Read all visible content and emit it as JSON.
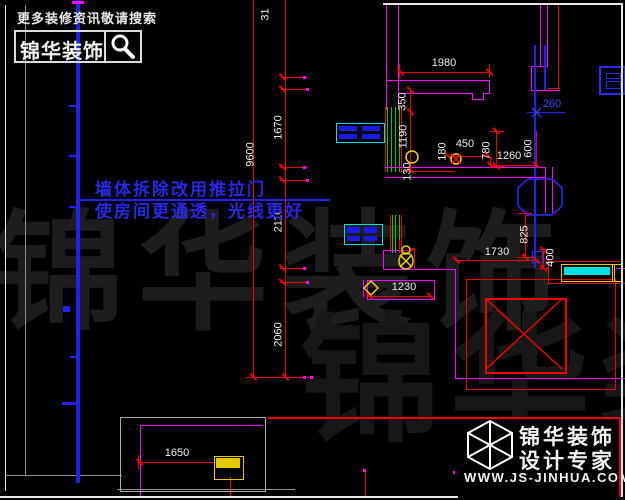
{
  "header": {
    "search_hint": "更多装修资讯敬请搜索",
    "brand": "锦华装饰"
  },
  "annotation": {
    "line1": "墙体拆除改用推拉门",
    "line2": "使房间更通透，光线更好"
  },
  "watermark": {
    "row1": "锦华装饰",
    "row2": "锦华装饰"
  },
  "footer_logo": {
    "brand": "锦华装饰",
    "tagline": "设计专家",
    "url": "WWW.JS-JINHUA.COM"
  },
  "dimensions": [
    {
      "t": "31",
      "x": 266,
      "y": 15,
      "o": "v"
    },
    {
      "t": "9600",
      "x": 251,
      "y": 155,
      "o": "v"
    },
    {
      "t": "1670",
      "x": 279,
      "y": 128,
      "o": "v"
    },
    {
      "t": "2110",
      "x": 279,
      "y": 221,
      "o": "v"
    },
    {
      "t": "2060",
      "x": 279,
      "y": 335,
      "o": "v"
    },
    {
      "t": "1980",
      "x": 444,
      "y": 64,
      "o": "h"
    },
    {
      "t": "350",
      "x": 403,
      "y": 102,
      "o": "v"
    },
    {
      "t": "1190",
      "x": 404,
      "y": 137,
      "o": "v"
    },
    {
      "t": "130",
      "x": 408,
      "y": 172,
      "o": "v"
    },
    {
      "t": "180",
      "x": 443,
      "y": 152,
      "o": "v"
    },
    {
      "t": "450",
      "x": 465,
      "y": 145,
      "o": "h"
    },
    {
      "t": "780",
      "x": 487,
      "y": 151,
      "o": "v"
    },
    {
      "t": "600",
      "x": 529,
      "y": 149,
      "o": "v"
    },
    {
      "t": "1260",
      "x": 509,
      "y": 157,
      "o": "h"
    },
    {
      "t": "260",
      "x": 552,
      "y": 105,
      "o": "h",
      "c": "blue"
    },
    {
      "t": "825",
      "x": 525,
      "y": 235,
      "o": "v"
    },
    {
      "t": "1730",
      "x": 497,
      "y": 253,
      "o": "h"
    },
    {
      "t": "400",
      "x": 551,
      "y": 258,
      "o": "v"
    },
    {
      "t": "1230",
      "x": 404,
      "y": 288,
      "o": "h"
    },
    {
      "t": "1650",
      "x": 177,
      "y": 454,
      "o": "h"
    }
  ],
  "icons": {
    "search": "magnifier-icon",
    "footer_logo": "cube-wireframe-icon",
    "ceiling_lamp": "ceiling-lamp-icon",
    "switch": "switch-icon",
    "outlet": "outlet-circle-icon",
    "marker": "diamond-marker-icon"
  },
  "colors": {
    "background": "#000000",
    "wall": "#ff00ff",
    "dimension_line": "#f00000",
    "dimension_text": "#f0f0f0",
    "window": "#00cc00",
    "furniture_frame": "#00e0e0",
    "furniture_fill": "#1a1ae0",
    "axis_blue": "#2222ee",
    "annotation_blue": "#2828e6",
    "highlight_yellow": "#e6c800",
    "cyan_fill": "#00e0e0",
    "watermark": "#1d1d1d"
  }
}
